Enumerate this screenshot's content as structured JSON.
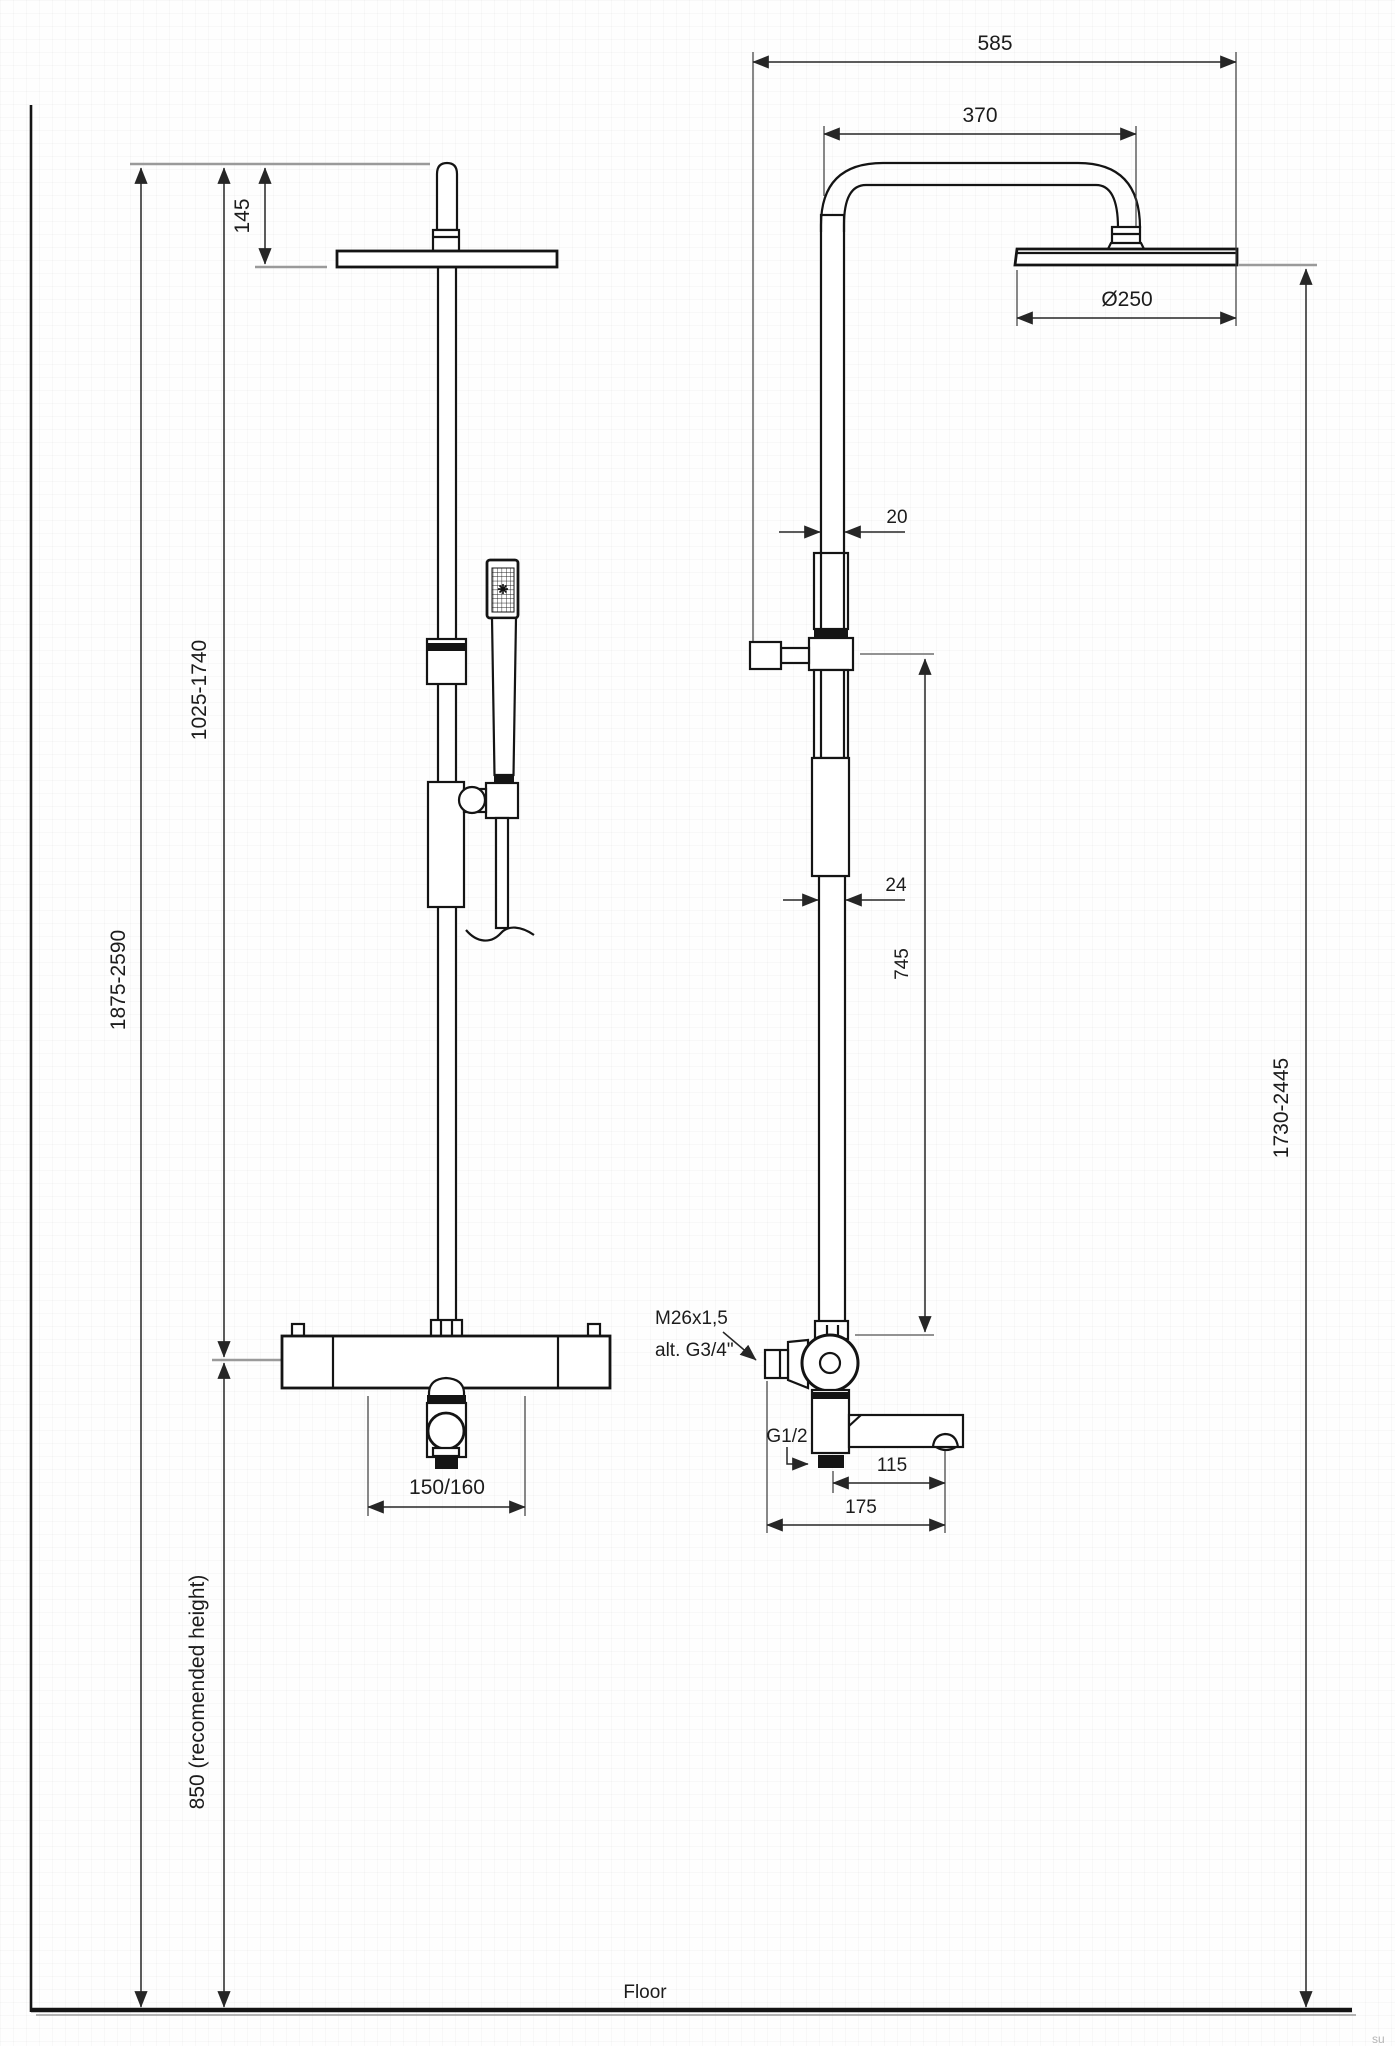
{
  "drawing": {
    "type": "shower-system-dimension-drawing",
    "colors": {
      "ink": "#141414",
      "dim": "#262626",
      "reference_gray": "#9a9a9a",
      "background": "#fefefe"
    }
  },
  "labels": {
    "dim_585": "585",
    "dim_370": "370",
    "dim_d250": "Ø250",
    "dim_145": "145",
    "dim_20": "20",
    "dim_24": "24",
    "dim_745": "745",
    "dim_1025_1740": "1025-1740",
    "dim_1875_2590": "1875-2590",
    "dim_1730_2445": "1730-2445",
    "dim_850": "850 (recomended height)",
    "dim_150_160": "150/160",
    "dim_115": "115",
    "dim_175": "175",
    "thread_m26": "M26x1,5",
    "thread_alt": "alt. G3/4\"",
    "thread_g12": "G1/2",
    "floor": "Floor",
    "watermark": "su"
  }
}
